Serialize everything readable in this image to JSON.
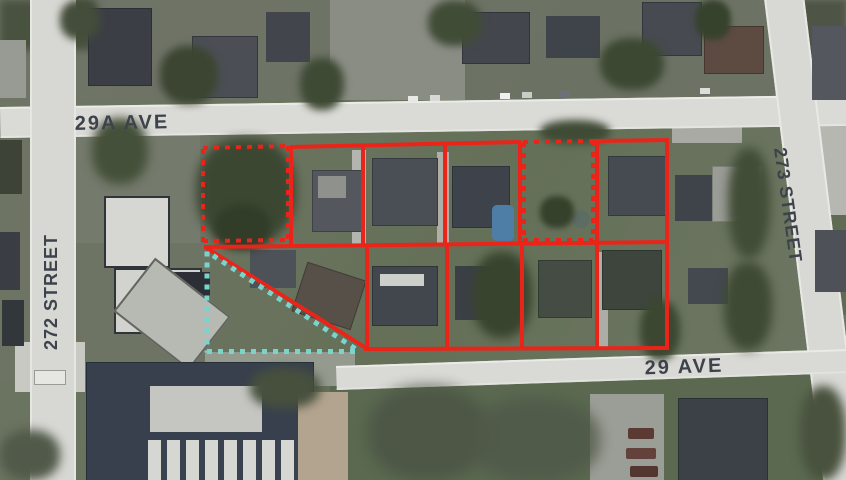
{
  "map": {
    "kind": "aerial-satellite-parcel-map",
    "width_px": 846,
    "height_px": 480
  },
  "streets": {
    "ave_29a": "29A AVE",
    "st_272": "272 STREET",
    "st_273": "273 STREET",
    "ave_29": "29 AVE"
  },
  "colors": {
    "lot_outline": "#ea2418",
    "highlight_dashed": "#79d4cd",
    "street_label": "#3d434b",
    "road": "#dadad6"
  },
  "overlay": {
    "solid_red_lines": [
      [
        290,
        147,
        521,
        142
      ],
      [
        594,
        141,
        669,
        140
      ],
      [
        204,
        247,
        669,
        242
      ],
      [
        364,
        349,
        669,
        348
      ],
      [
        291,
        147,
        291,
        246
      ],
      [
        363,
        146,
        363,
        245
      ],
      [
        445,
        144,
        445,
        245
      ],
      [
        520,
        143,
        520,
        244
      ],
      [
        597,
        141,
        597,
        349
      ],
      [
        667,
        140,
        667,
        349
      ],
      [
        367,
        245,
        367,
        348
      ],
      [
        447,
        244,
        447,
        348
      ],
      [
        522,
        243,
        522,
        348
      ],
      [
        205,
        247,
        366,
        348
      ]
    ],
    "dashed_red_lines": [
      [
        203,
        149,
        203,
        242
      ],
      [
        203,
        148,
        289,
        146
      ],
      [
        288,
        146,
        288,
        241
      ],
      [
        203,
        241,
        288,
        240
      ],
      [
        524,
        142,
        524,
        242
      ],
      [
        523,
        142,
        594,
        141
      ],
      [
        593,
        141,
        593,
        242
      ],
      [
        523,
        240,
        593,
        240
      ]
    ],
    "dashed_teal_lines": [
      [
        207,
        251,
        207,
        352
      ],
      [
        207,
        351,
        361,
        351
      ],
      [
        213,
        255,
        358,
        350
      ]
    ]
  }
}
